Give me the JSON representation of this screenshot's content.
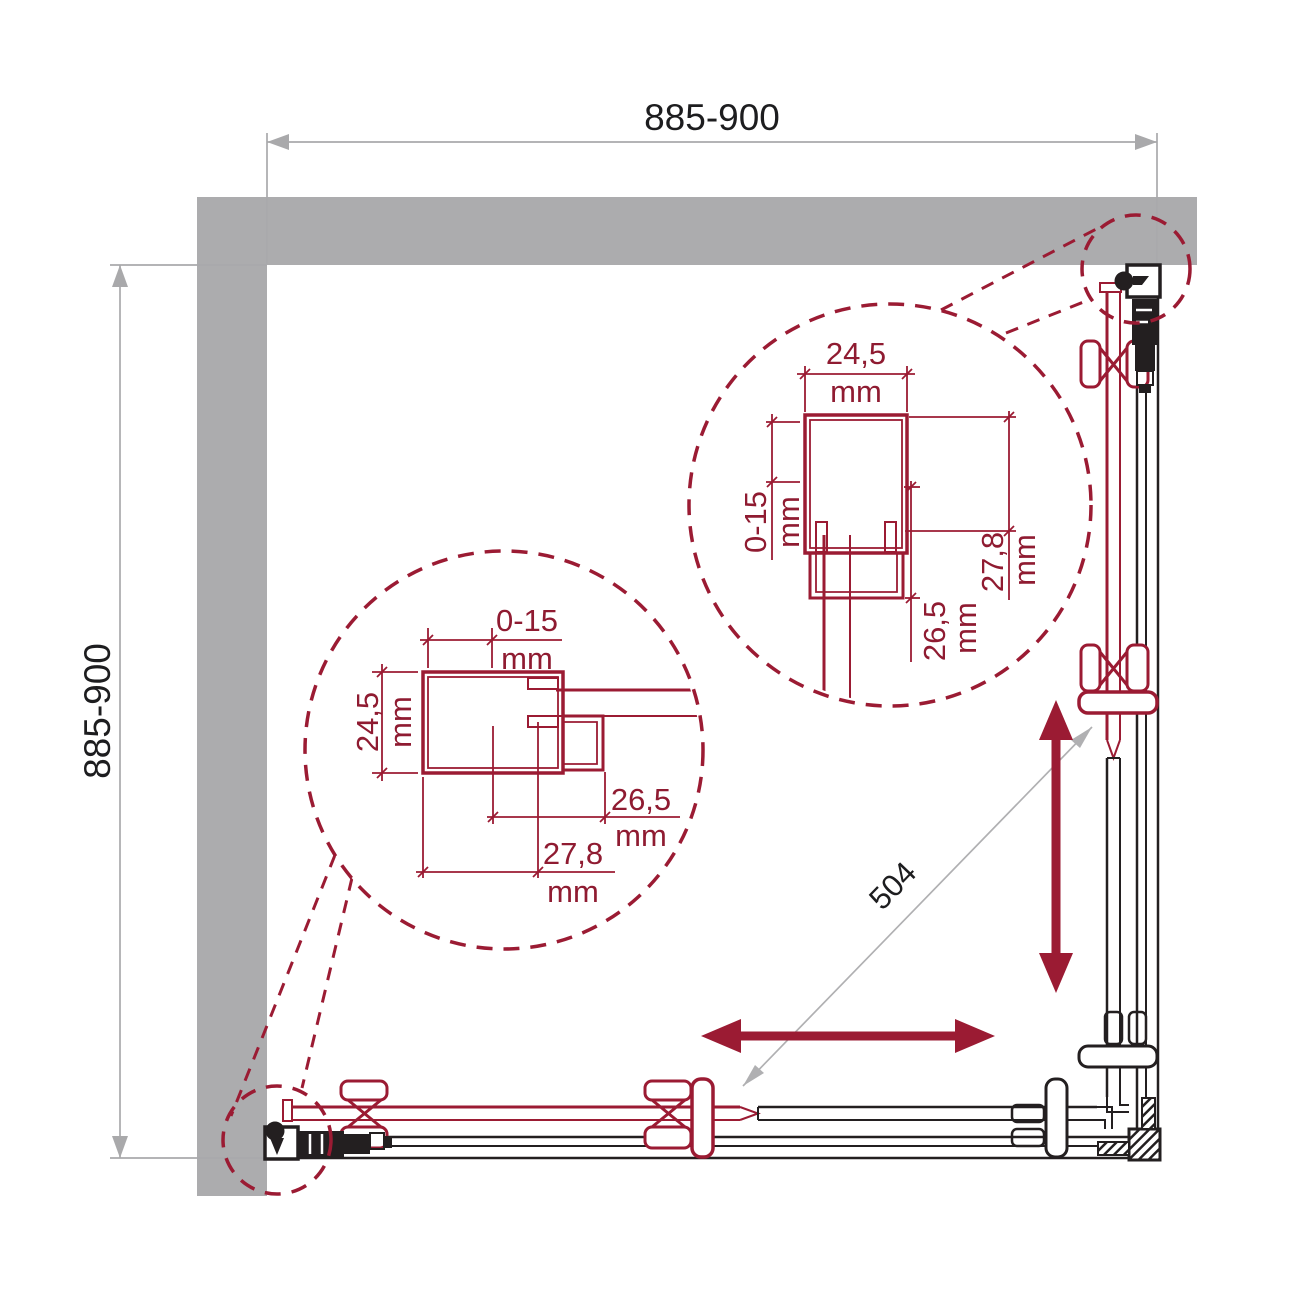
{
  "colors": {
    "accent_maroon": "#9b1b33",
    "wall_gray": "#acacae",
    "dim_gray": "#a9a9ab",
    "text_black": "#1d1d1f",
    "background": "#ffffff"
  },
  "overall_dimensions": {
    "top_width": "885-900",
    "left_height": "885-900",
    "diagonal_opening": "504"
  },
  "detail_top_right": {
    "profile_width": {
      "value": "24,5",
      "unit": "mm"
    },
    "adjustment_range": {
      "value": "0-15",
      "unit": "mm"
    },
    "overall_depth": {
      "value": "27,8",
      "unit": "mm"
    },
    "channel_depth": {
      "value": "26,5",
      "unit": "mm"
    }
  },
  "detail_bottom_left": {
    "adjustment_range": {
      "value": "0-15",
      "unit": "mm"
    },
    "profile_width": {
      "value": "24,5",
      "unit": "mm"
    },
    "channel_depth": {
      "value": "26,5",
      "unit": "mm"
    },
    "overall_depth": {
      "value": "27,8",
      "unit": "mm"
    }
  }
}
